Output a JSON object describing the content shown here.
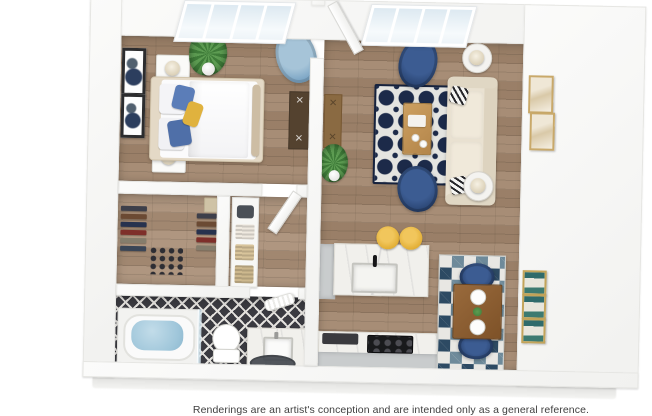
{
  "caption": "Renderings are an artist's conception and are intended only as a general reference.",
  "floorplan": {
    "type": "apartment-3d-floorplan-top-view",
    "rooms": [
      {
        "name": "bedroom",
        "furniture": [
          "queen-bed",
          "nightstand-with-lamp",
          "nightstand-with-lamp",
          "framed-wall-art",
          "framed-wall-art",
          "potted-plant",
          "accent-armchair",
          "desk"
        ]
      },
      {
        "name": "living-room",
        "furniture": [
          "sofa",
          "patterned-area-rug",
          "coffee-table",
          "armchair",
          "armchair",
          "side-table-with-lamp",
          "side-table-with-lamp",
          "console-table",
          "potted-plant",
          "framed-wall-art",
          "framed-wall-art",
          "open-door"
        ]
      },
      {
        "name": "walk-in-closet",
        "furniture": [
          "hanging-clothes-rack",
          "hanging-clothes-rack",
          "shoe-rows",
          "storage-box"
        ]
      },
      {
        "name": "hallway",
        "furniture": [
          "shelf-with-baskets",
          "open-door"
        ]
      },
      {
        "name": "bathroom",
        "furniture": [
          "bathtub",
          "glass-screen",
          "toilet",
          "vanity-with-sink",
          "rolled-towel",
          "round-rug"
        ]
      },
      {
        "name": "kitchen",
        "furniture": [
          "marble-island-with-sink",
          "bar-stool",
          "bar-stool",
          "counter-with-stove",
          "side-counter"
        ]
      },
      {
        "name": "dining-area",
        "furniture": [
          "dining-table",
          "dining-chair",
          "dining-chair",
          "triangle-area-rug",
          "wall-art-triptych"
        ]
      }
    ],
    "colors": {
      "wood_floor": "#a2866d",
      "wall": "#f8f8f7",
      "rug_navy": "#1c2a49",
      "armchair_navy": "#2a4573",
      "bedroom_chair_blue": "#7ea7c6",
      "sofa_cream": "#e9e1d1",
      "stool_yellow": "#e2ae34",
      "bath_tile": "#3b3b41",
      "tub_water": "#9fc6da",
      "marble": "#f1f0ec",
      "table_wood": "#8a5c30"
    }
  }
}
